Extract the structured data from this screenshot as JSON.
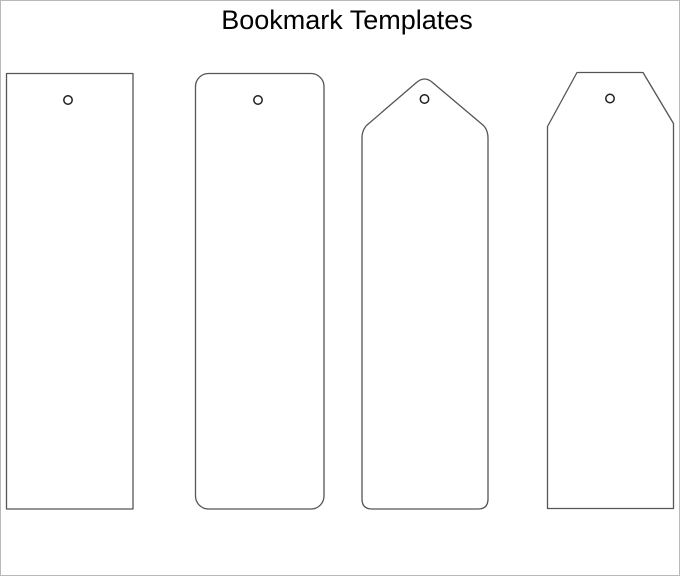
{
  "page": {
    "title": "Bookmark Templates"
  },
  "canvas": {
    "background_color": "#ffffff",
    "frame_border_color": "#b9b9b9",
    "outline_color": "#555555",
    "hole_outline_color": "#1f1f1f",
    "title_color": "#000000"
  },
  "templates": [
    {
      "name": "Rectangle bookmark template",
      "shape": "rectangle",
      "has_punch_hole": true
    },
    {
      "name": "Rounded rectangle bookmark template",
      "shape": "rounded-rectangle",
      "has_punch_hole": true
    },
    {
      "name": "Pointed top bookmark template",
      "shape": "pointed-top-tag",
      "has_punch_hole": true
    },
    {
      "name": "Chamfered top bookmark template",
      "shape": "chamfered-top-tag",
      "has_punch_hole": true
    }
  ]
}
